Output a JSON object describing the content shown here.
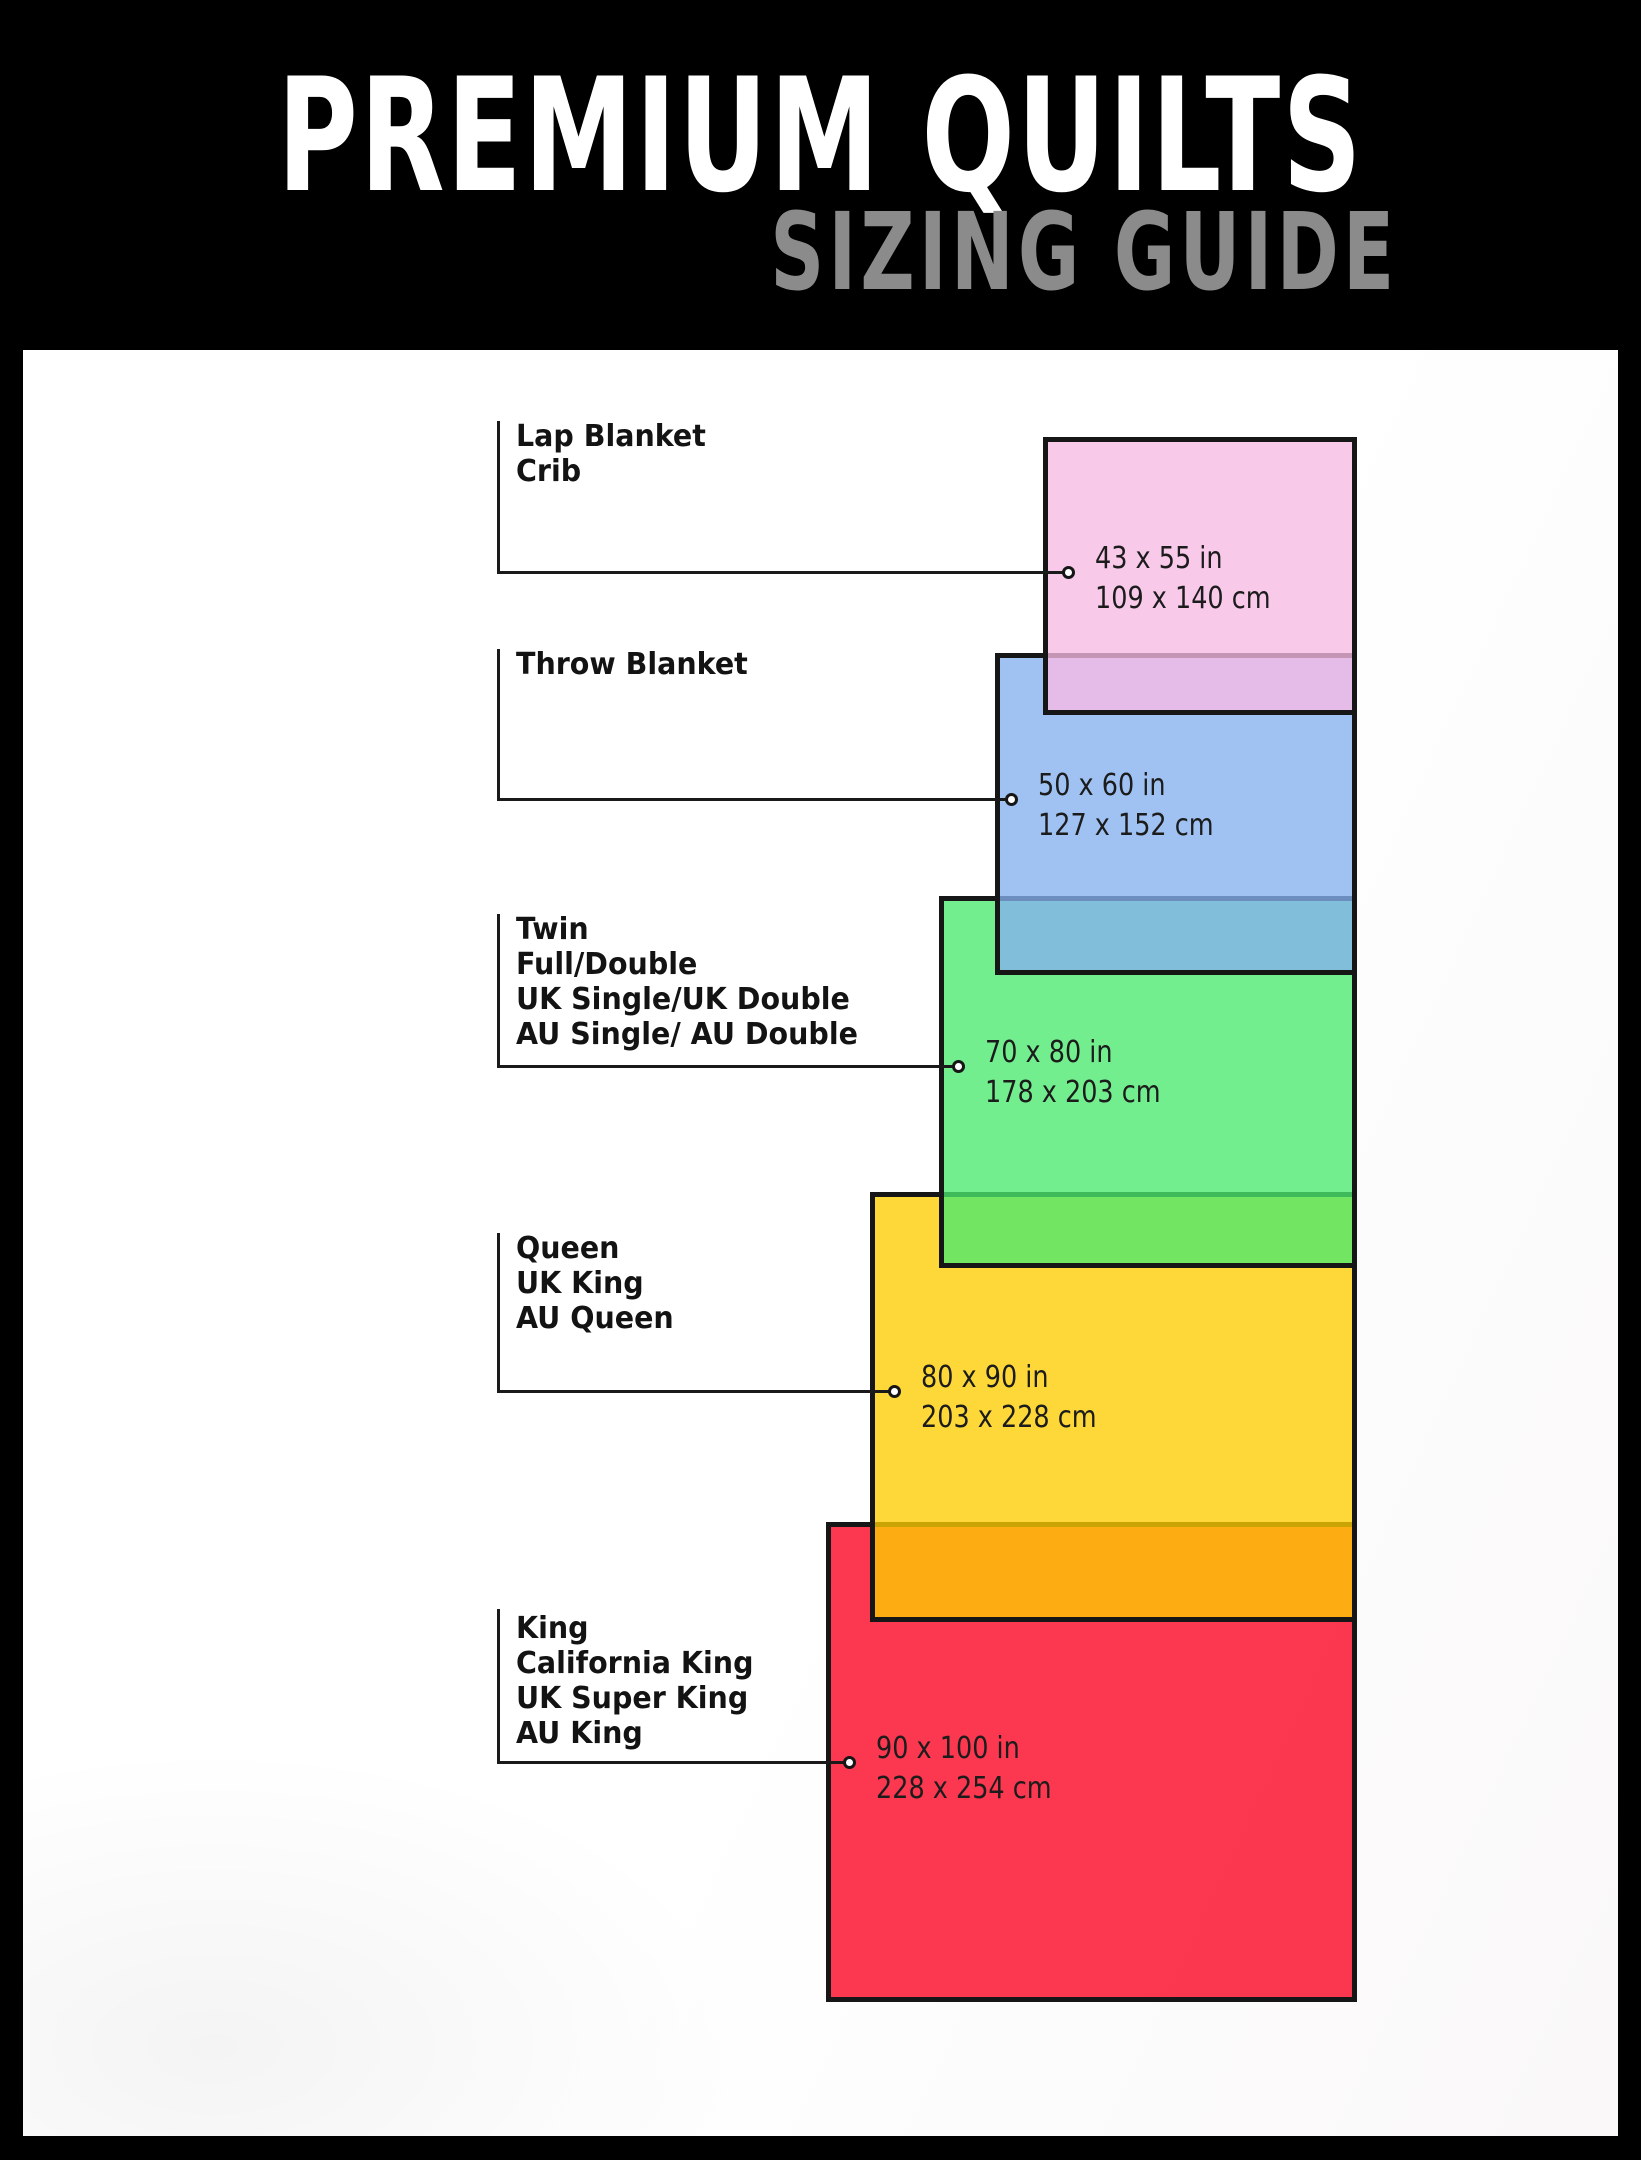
{
  "header": {
    "title": "PREMIUM QUILTS",
    "subtitle": "SIZING GUIDE",
    "background": "#000000",
    "title_color": "#ffffff",
    "subtitle_color": "#8b8b8b"
  },
  "sizes": [
    {
      "labels": [
        "Lap Blanket",
        "Crib"
      ],
      "inches": "43 x 55 in",
      "cm": "109 x 140 cm",
      "color": "#F7BAE4"
    },
    {
      "labels": [
        "Throw Blanket"
      ],
      "inches": "50 x 60 in",
      "cm": "127 x 152 cm",
      "color": "#84B1EE"
    },
    {
      "labels": [
        "Twin",
        "Full/Double",
        "UK Single/UK Double",
        "AU Single/ AU Double"
      ],
      "inches": "70 x 80 in",
      "cm": "178 x 203 cm",
      "color": "#4AE96E"
    },
    {
      "labels": [
        "Queen",
        "UK King",
        "AU Queen"
      ],
      "inches": "80 x 90 in",
      "cm": "203 x 228 cm",
      "color": "#FECD00"
    },
    {
      "labels": [
        "King",
        "California King",
        "UK Super King",
        "AU King"
      ],
      "inches": "90 x 100 in",
      "cm": "228 x 254 cm",
      "color": "#FA001F"
    }
  ],
  "rect_border_color": "#161616",
  "rect_fill_opacity": 0.78
}
